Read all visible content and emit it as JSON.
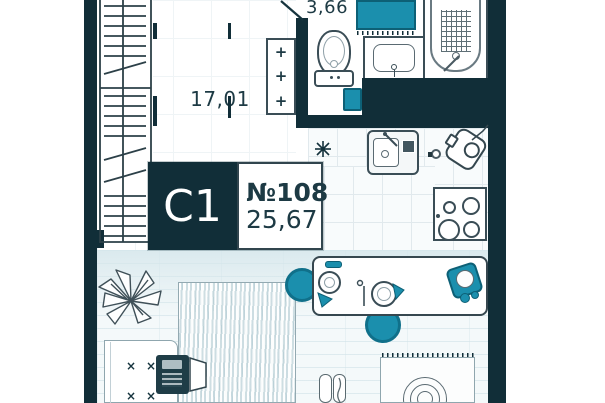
{
  "floor_plan": {
    "unit_badge": {
      "type": "С1",
      "number": "№108",
      "total_area": "25,67"
    },
    "rooms": [
      {
        "id": "living-room",
        "area_label": "17,01"
      },
      {
        "id": "bathroom",
        "area_label": "3,66"
      }
    ],
    "symbols": {
      "vent_plus": "+",
      "furniture_cross": "×"
    },
    "colors": {
      "wall": "#112e38",
      "accent": "#1b8fad",
      "text": "#1d3a44",
      "outline": "#3a4d56"
    },
    "fixtures": [
      "wardrobe",
      "radiator-vent",
      "toilet",
      "washbasin",
      "bathtub",
      "bath-mat",
      "trash-bin",
      "kitchen-sink",
      "kettle",
      "stove",
      "star-marker",
      "dining-table",
      "stool",
      "chair",
      "bed",
      "desk",
      "laptop",
      "plant",
      "rug",
      "ironing-board"
    ]
  }
}
